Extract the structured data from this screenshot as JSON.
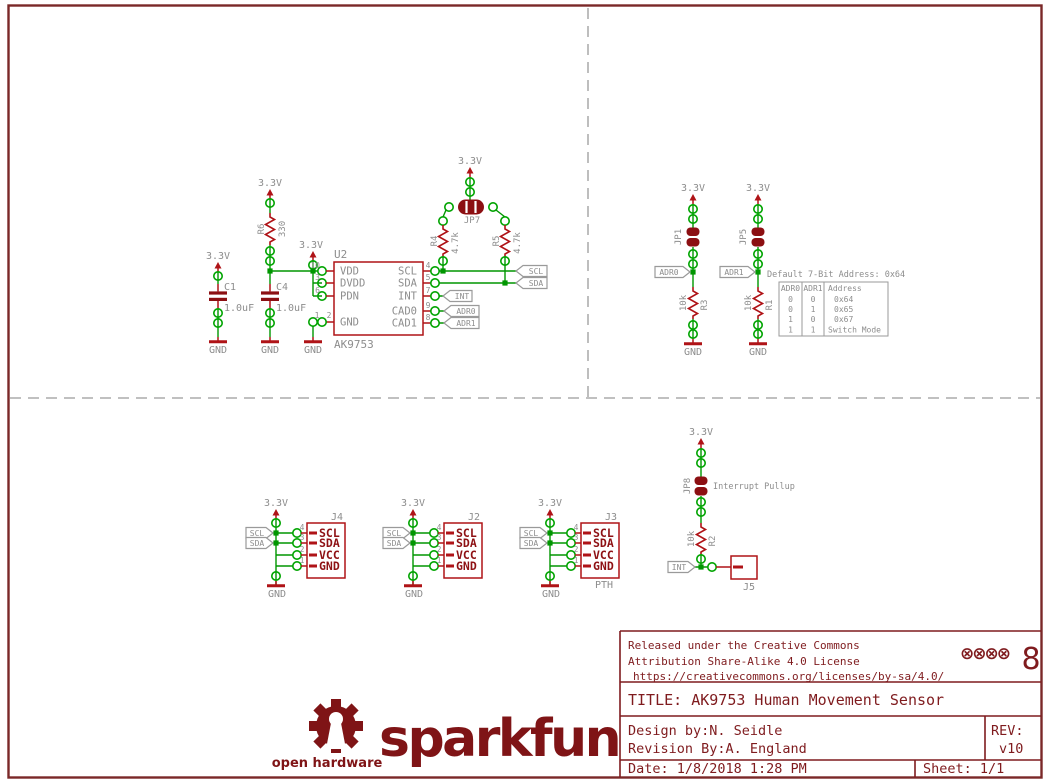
{
  "colors": {
    "component_red": "#af1317",
    "dark_red_fill": "#8c0f12",
    "pin_label_red": "#8e1114",
    "wire_green": "#009600",
    "pad_green": "#00a400",
    "label_gray": "#8d8d8d",
    "title_maroon": "#7f1b1e",
    "logo_maroon": "#7f1416",
    "border_red": "#7a2828",
    "divider_gray": "#9b9b9b"
  },
  "nets": {
    "v33": "3.3V",
    "gnd": "GND"
  },
  "flags": {
    "scl": "SCL",
    "sda": "SDA",
    "int": "INT",
    "adr0": "ADR0",
    "adr1": "ADR1"
  },
  "ic": {
    "ref": "U2",
    "value": "AK9753",
    "pins": {
      "vdd": {
        "num": "10",
        "name": "VDD"
      },
      "dvdd": {
        "num": "3",
        "name": "DVDD"
      },
      "pdn": {
        "num": "6",
        "name": "PDN"
      },
      "gnd": {
        "num1": "1",
        "num2": "2",
        "name": "GND"
      },
      "scl": {
        "num": "4",
        "name": "SCL"
      },
      "sda": {
        "num": "5",
        "name": "SDA"
      },
      "int": {
        "num": "7",
        "name": "INT"
      },
      "cad0": {
        "num": "9",
        "name": "CAD0"
      },
      "cad1": {
        "num": "8",
        "name": "CAD1"
      }
    }
  },
  "capacitors": {
    "c1": {
      "ref": "C1",
      "value": "1.0uF"
    },
    "c4": {
      "ref": "C4",
      "value": "1.0uF"
    }
  },
  "resistors": {
    "r6": {
      "ref": "R6",
      "value": "330"
    },
    "r4": {
      "ref": "R4",
      "value": "4.7k"
    },
    "r5": {
      "ref": "R5",
      "value": "4.7k"
    },
    "r3": {
      "ref": "R3",
      "value": "10k"
    },
    "r1": {
      "ref": "R1",
      "value": "10k"
    },
    "r2": {
      "ref": "R2",
      "value": "10k"
    }
  },
  "jumpers": {
    "jp7": {
      "ref": "JP7"
    },
    "jp1": {
      "ref": "JP1"
    },
    "jp5": {
      "ref": "JP5"
    },
    "jp8": {
      "ref": "JP8",
      "note": "Interrupt Pullup"
    }
  },
  "address_table": {
    "title": "Default 7-Bit Address: 0x64",
    "headers": [
      "ADR0",
      "ADR1",
      "Address"
    ],
    "rows": [
      [
        "0",
        "0",
        "0x64"
      ],
      [
        "0",
        "1",
        "0x65"
      ],
      [
        "1",
        "0",
        "0x67"
      ],
      [
        "1",
        "1",
        "Switch Mode"
      ]
    ]
  },
  "connectors": {
    "j4": {
      "ref": "J4",
      "pin_numbers": [
        "4",
        "3",
        "2",
        "1"
      ],
      "pin_labels": [
        "SCL",
        "SDA",
        "VCC",
        "GND"
      ]
    },
    "j2": {
      "ref": "J2",
      "pin_numbers": [
        "4",
        "3",
        "2",
        "1"
      ],
      "pin_labels": [
        "SCL",
        "SDA",
        "VCC",
        "GND"
      ]
    },
    "j3": {
      "ref": "J3",
      "note": "PTH",
      "pin_numbers": [
        "4",
        "3",
        "2",
        "1"
      ],
      "pin_labels": [
        "SCL",
        "SDA",
        "VCC",
        "GND"
      ]
    },
    "j5": {
      "ref": "J5"
    }
  },
  "title_block": {
    "license_line1": "Released under the Creative Commons",
    "license_line2": "Attribution Share-Alike 4.0 License",
    "license_url": "https://creativecommons.org/licenses/by-sa/4.0/",
    "marks": "⊗⊗⊗⊗",
    "figure8": "8",
    "title": "TITLE: AK9753 Human Movement Sensor",
    "design_by": "Design by:N. Seidle",
    "revision_by": "Revision By:A. England",
    "rev_label": "REV:",
    "rev_value": "v10",
    "date": "Date: 1/8/2018 1:28 PM",
    "sheet": "Sheet: 1/1"
  },
  "logo": {
    "brand": "sparkfun",
    "tagline": "open hardware"
  }
}
